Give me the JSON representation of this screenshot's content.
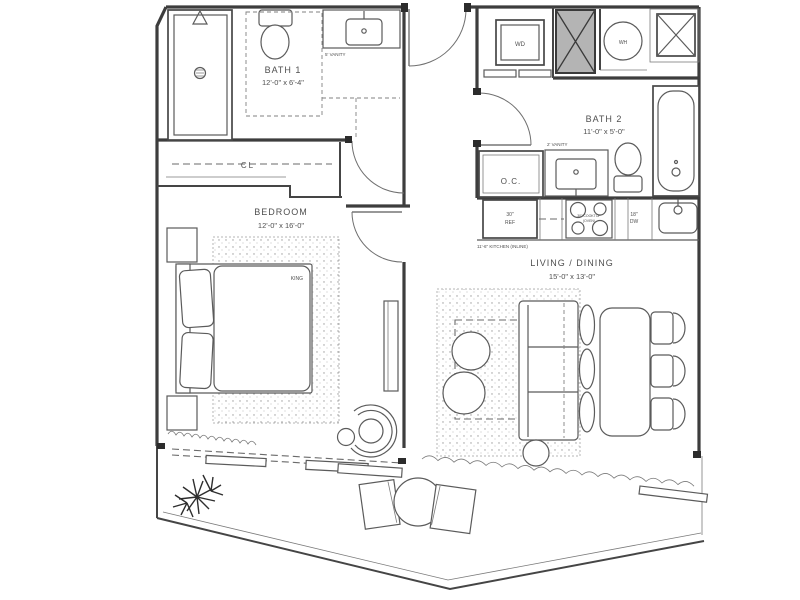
{
  "colors": {
    "background": "#ffffff",
    "wall": "#3d3d3d",
    "line": "#5b5b5b",
    "text": "#4f4f4f",
    "shaft_fill": "#b4b4b4"
  },
  "rooms": {
    "bath1": {
      "name": "BATH 1",
      "dims": "12'-0\" x 6'-4\""
    },
    "bath2": {
      "name": "BATH 2",
      "dims": "11'-0\" x 5'-0\""
    },
    "bedroom": {
      "name": "BEDROOM",
      "dims": "12'-0\" x 16'-0\""
    },
    "living_dining": {
      "name": "LIVING / DINING",
      "dims": "15'-0\" x 13'-0\""
    },
    "closet": {
      "name": "CL"
    },
    "owners_closet": {
      "name": "O.C."
    }
  },
  "fixtures": {
    "washer_dryer": "WD",
    "water_heater": "WH",
    "bed_size": "KING",
    "fridge_width": "30\"",
    "fridge": "REF",
    "cooktop_line1": "30\" COOKTOP",
    "cooktop_line2": "(OVEN)",
    "dishwasher_width": "18\"",
    "dishwasher": "DW",
    "kitchen_note": "11'-6\" KITCHEN (INLINE)",
    "bath1_vanity": "5' VANITY",
    "bath2_vanity": "2' VANITY"
  }
}
